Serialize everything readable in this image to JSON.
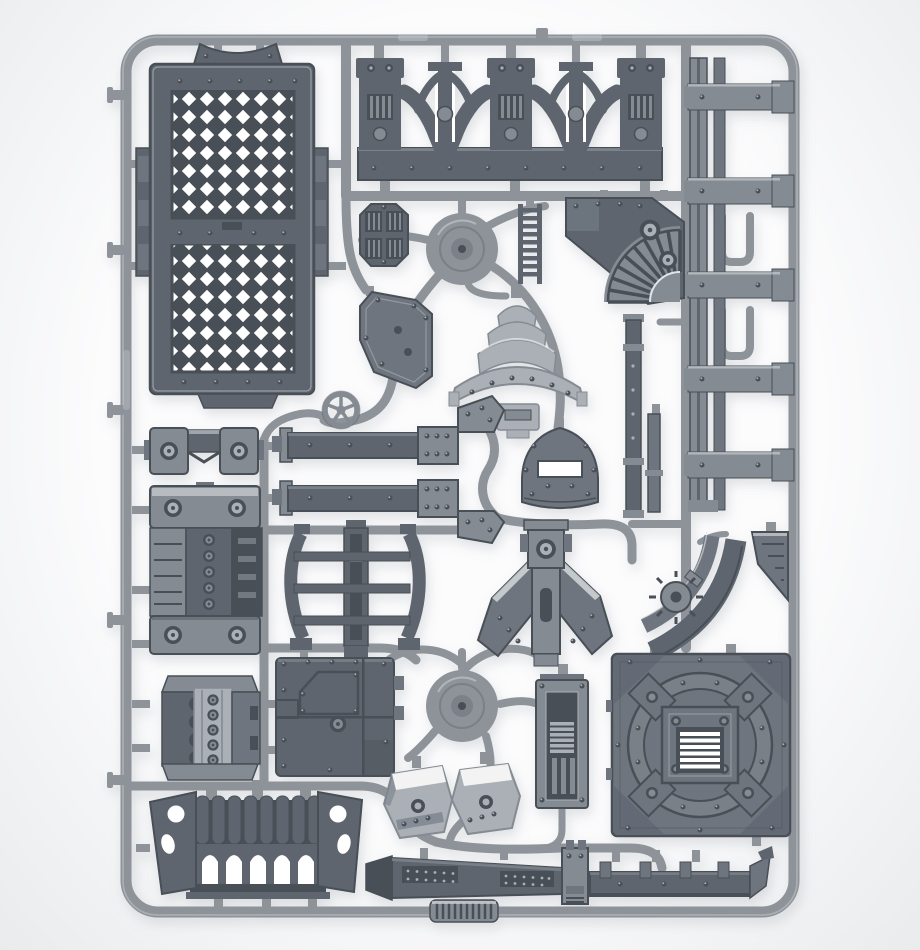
{
  "colors": {
    "background": "#fcfcfd",
    "vignette_edge": "#e9ebed",
    "shadow": "#9aa1a7",
    "runner": "#8d9399",
    "runner_light": "#c0c5c9",
    "runner_dark": "#6d737a",
    "part_dark": "#5e656e",
    "part_darker": "#494f57",
    "part_plate": "#6e757e",
    "part_mid": "#858b92",
    "part_light": "#abb0b6",
    "part_highlight": "#e2e5e7",
    "hole_white": "#ffffff"
  },
  "parts": {
    "frame": "plastic sprue outer frame",
    "runners": "sprue runner network",
    "grating_panel": "diamond grating floor panel",
    "arch_wall": "double arch wall section",
    "arch_strut_1": "arch keystone strut",
    "arch_strut_2": "arch keystone strut",
    "girder_column": "stacked girder beams",
    "vent_plate": "octagonal vent plate",
    "hub_top": "upper injection hub",
    "hub_bottom": "lower injection hub",
    "ladder": "access ladder",
    "louver_quadrant": "curved louver vent quadrant",
    "gusset_plate": "riveted gusset plate",
    "dome_stack": "tiered dome segment",
    "hand_wheel": "five-spoke hand wheel",
    "beam_upper": "riveted girder beam",
    "beam_lower": "riveted girder beam",
    "shield_hatch": "arched hatch cover",
    "support_columns": "slender support columns",
    "curved_brace": "curved triple-rail brace",
    "winged_bracket": "winged support bracket",
    "duct_segments": "curved duct segments with valve",
    "ramp_wedge": "striated ramp wedge",
    "pipe_clamp": "pipe clamp bracket",
    "storage_tank": "bolted storage tank",
    "engine_block": "ribbed engine block",
    "access_panel": "riveted access panel",
    "control_cabinet": "vented control cabinet",
    "hood_left": "angled hood cover",
    "hood_right": "angled hood cover",
    "arcade": "five-arch arcade section",
    "walkway_angled": "angled walkway girder",
    "walkway_straight": "cleated walkway girder",
    "ribbed_strip": "ribbed connector strip",
    "platform": "circular-pattern platform tile"
  }
}
